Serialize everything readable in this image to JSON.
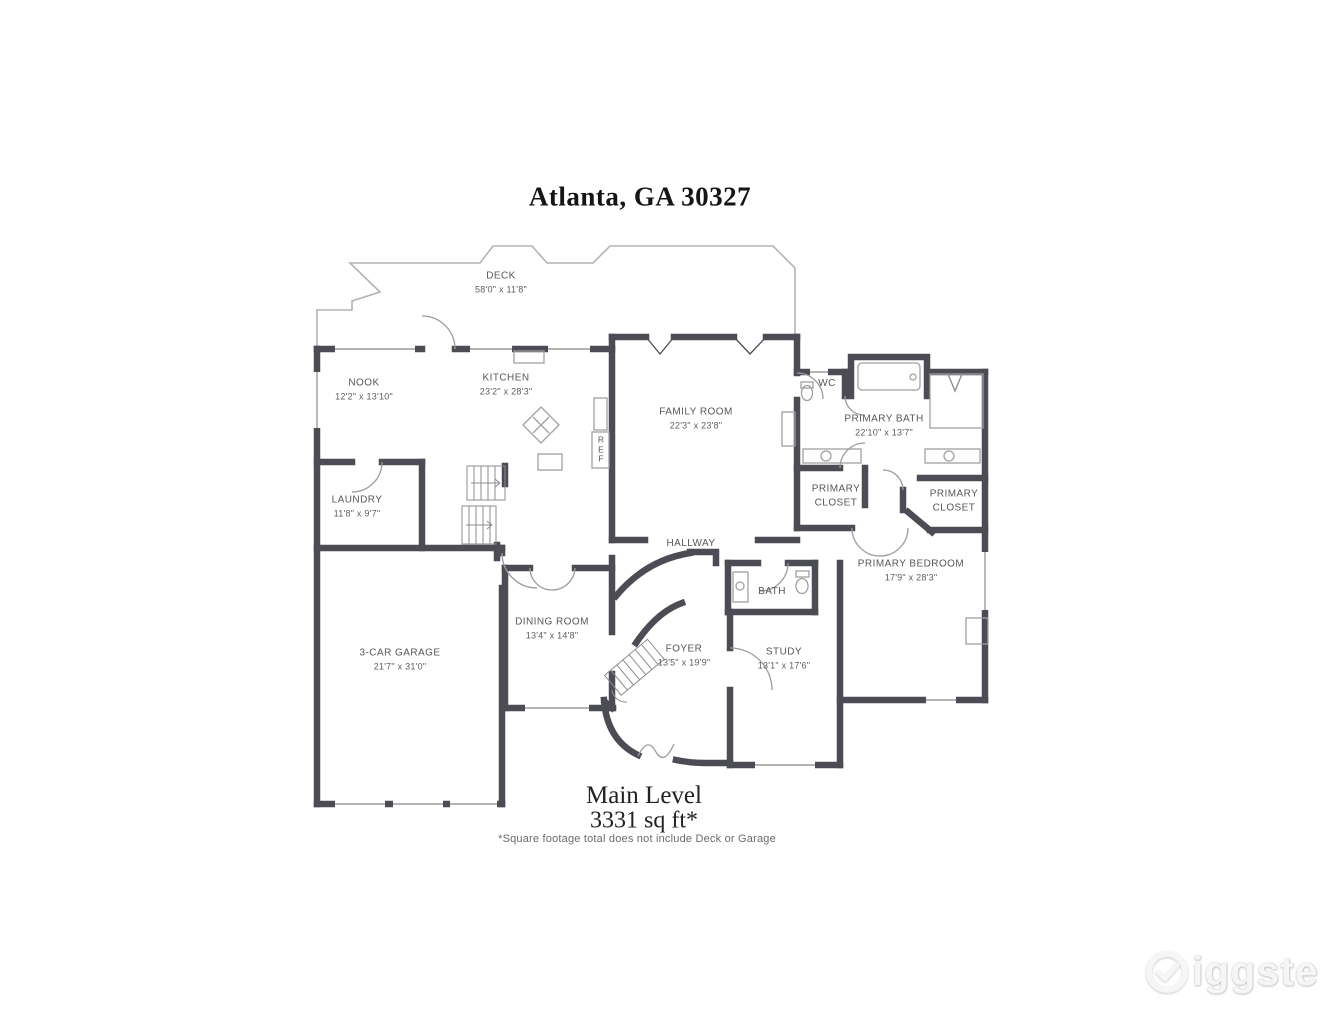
{
  "title": "Atlanta, GA 30327",
  "rooms": {
    "deck": {
      "name": "DECK",
      "dims": "58'0\" x 11'8\""
    },
    "nook": {
      "name": "NOOK",
      "dims": "12'2\" x 13'10\""
    },
    "kitchen": {
      "name": "KITCHEN",
      "dims": "23'2\" x 28'3\""
    },
    "family_room": {
      "name": "FAMILY ROOM",
      "dims": "22'3\" x 23'8\""
    },
    "wc": {
      "name": "WC"
    },
    "primary_bath": {
      "name": "PRIMARY BATH",
      "dims": "22'10\" x 13'7\""
    },
    "primary_closet_left": {
      "name": "PRIMARY CLOSET"
    },
    "primary_closet_right": {
      "name": "PRIMARY CLOSET"
    },
    "laundry": {
      "name": "LAUNDRY",
      "dims": "11'8\" x 9'7\""
    },
    "hallway": {
      "name": "HALLWAY"
    },
    "bath": {
      "name": "BATH"
    },
    "primary_bedroom": {
      "name": "PRIMARY BEDROOM",
      "dims": "17'9\" x 28'3\""
    },
    "dining_room": {
      "name": "DINING ROOM",
      "dims": "13'4\" x 14'8\""
    },
    "foyer": {
      "name": "FOYER",
      "dims": "13'5\" x 19'9\""
    },
    "study": {
      "name": "STUDY",
      "dims": "13'1\" x 17'6\""
    },
    "garage": {
      "name": "3-CAR GARAGE",
      "dims": "21'7\" x 31'0\""
    },
    "ref": {
      "name": "REF"
    }
  },
  "footer": {
    "level": "Main Level",
    "area": "3331 sq ft*",
    "note": "*Square footage total does not include Deck or Garage"
  },
  "watermark": {
    "brand": "Giggster",
    "wordmark_text": "iggster"
  },
  "colors": {
    "wall": "#4c4c54",
    "thin_line": "#9b9b9b",
    "label_text": "#575757"
  }
}
